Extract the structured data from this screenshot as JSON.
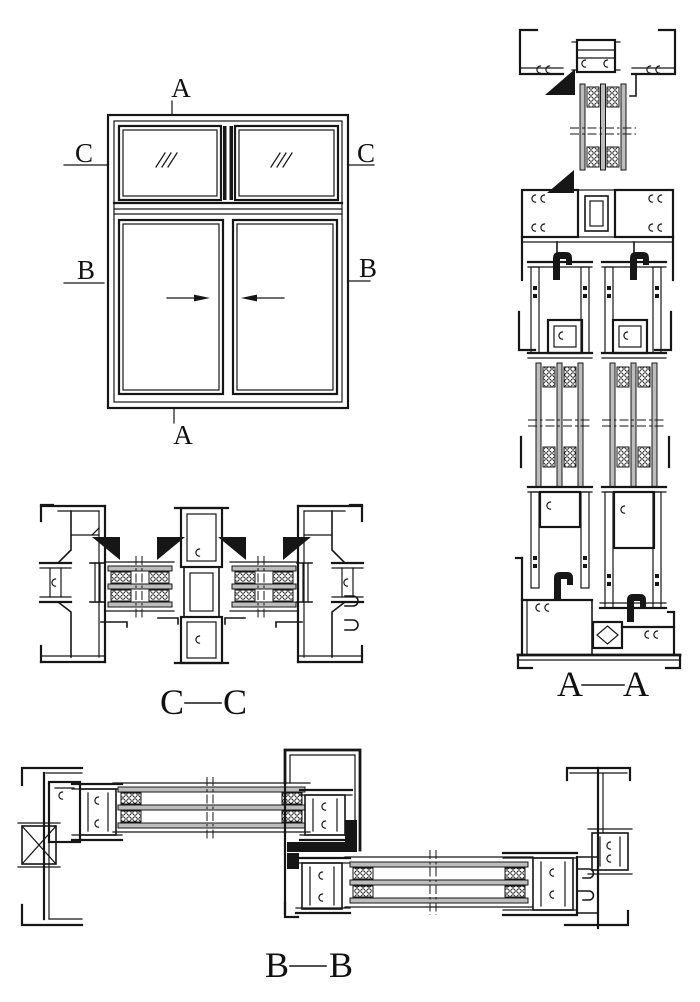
{
  "drawing": {
    "kind": "window-system-section-drawing",
    "background_color": "#ffffff",
    "line_color": "#161616",
    "glass_fill_color": "#bdbdbd"
  },
  "elevation": {
    "markers": {
      "top": "A",
      "bottom": "A",
      "left_upper": "C",
      "right_upper": "C",
      "left_lower": "B",
      "right_lower": "B"
    }
  },
  "sections": {
    "aa": {
      "left": "A",
      "right": "A"
    },
    "cc": {
      "left": "C",
      "right": "C"
    },
    "bb": {
      "left": "B",
      "right": "B"
    }
  }
}
